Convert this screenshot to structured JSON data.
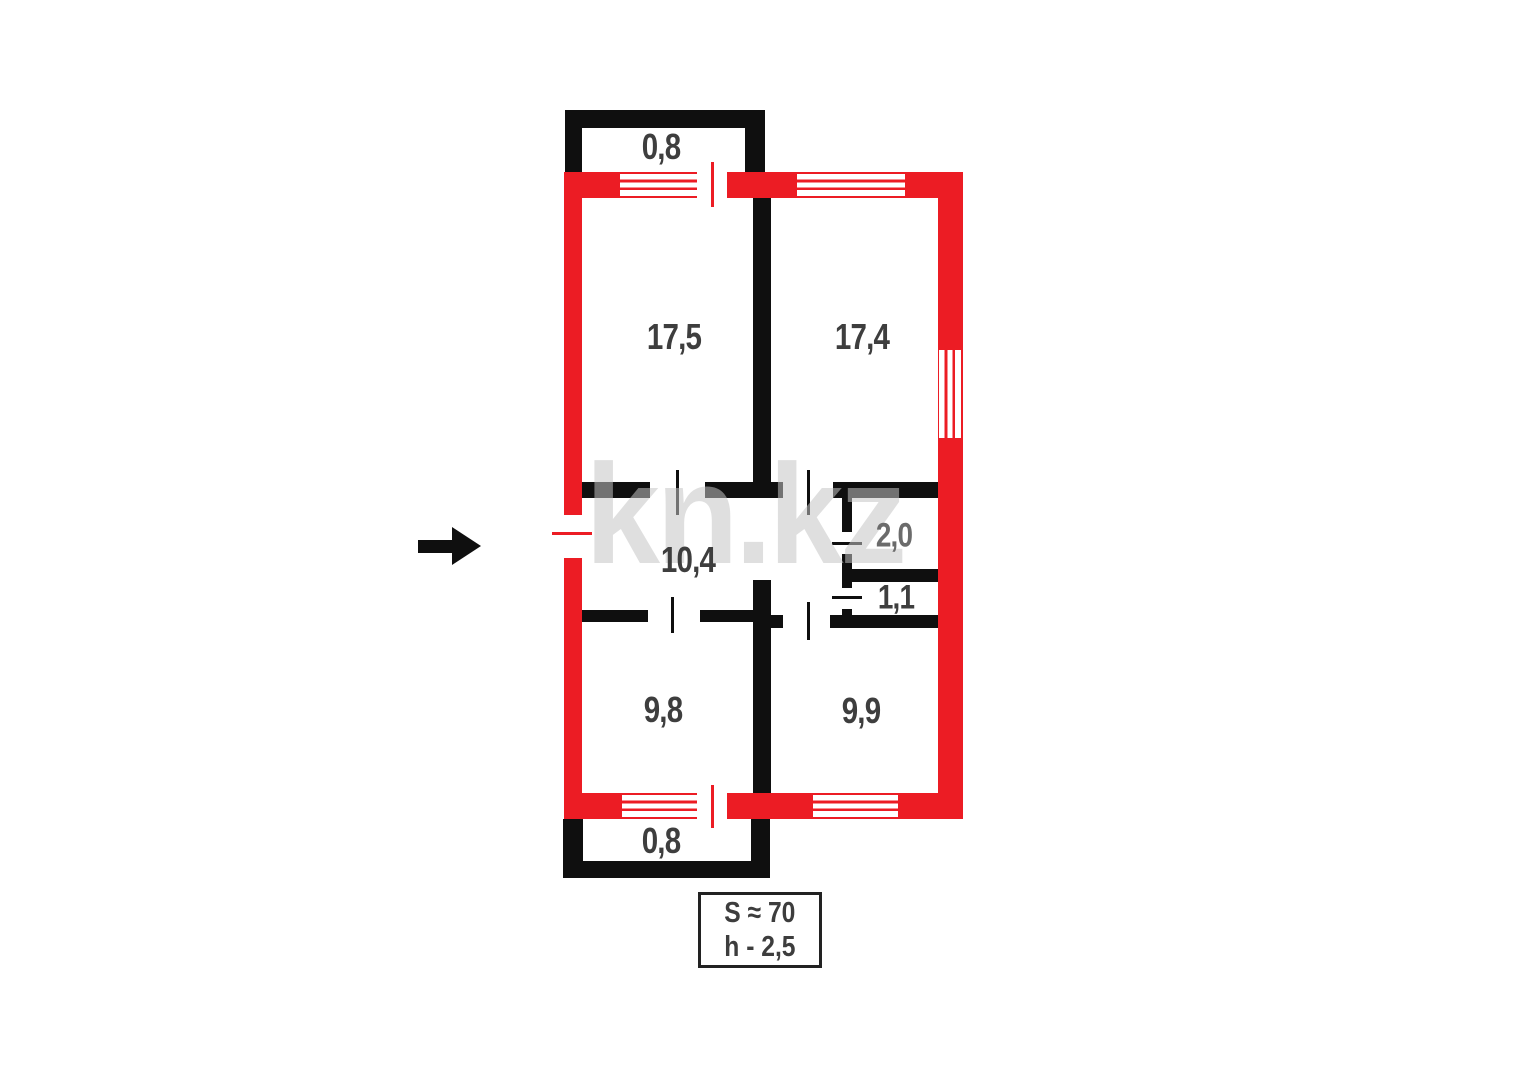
{
  "plan": {
    "watermark": "kn.kz",
    "rooms": [
      {
        "id": "balcony-top",
        "area": "0,8"
      },
      {
        "id": "room-17-5",
        "area": "17,5"
      },
      {
        "id": "room-17-4",
        "area": "17,4"
      },
      {
        "id": "hallway",
        "area": "10,4"
      },
      {
        "id": "bathroom",
        "area": "2,0"
      },
      {
        "id": "wc",
        "area": "1,1"
      },
      {
        "id": "room-9-8",
        "area": "9,8"
      },
      {
        "id": "room-9-9",
        "area": "9,9"
      },
      {
        "id": "balcony-bottom",
        "area": "0,8"
      }
    ],
    "info_box": {
      "total_area": "S ≈ 70",
      "ceiling_height": "h - 2,5"
    },
    "colors": {
      "exterior_wall": "#ec1c24",
      "interior_wall": "#0f0f0f",
      "label": "#3e3e3e",
      "label_muted": "#6b6b6b"
    }
  }
}
